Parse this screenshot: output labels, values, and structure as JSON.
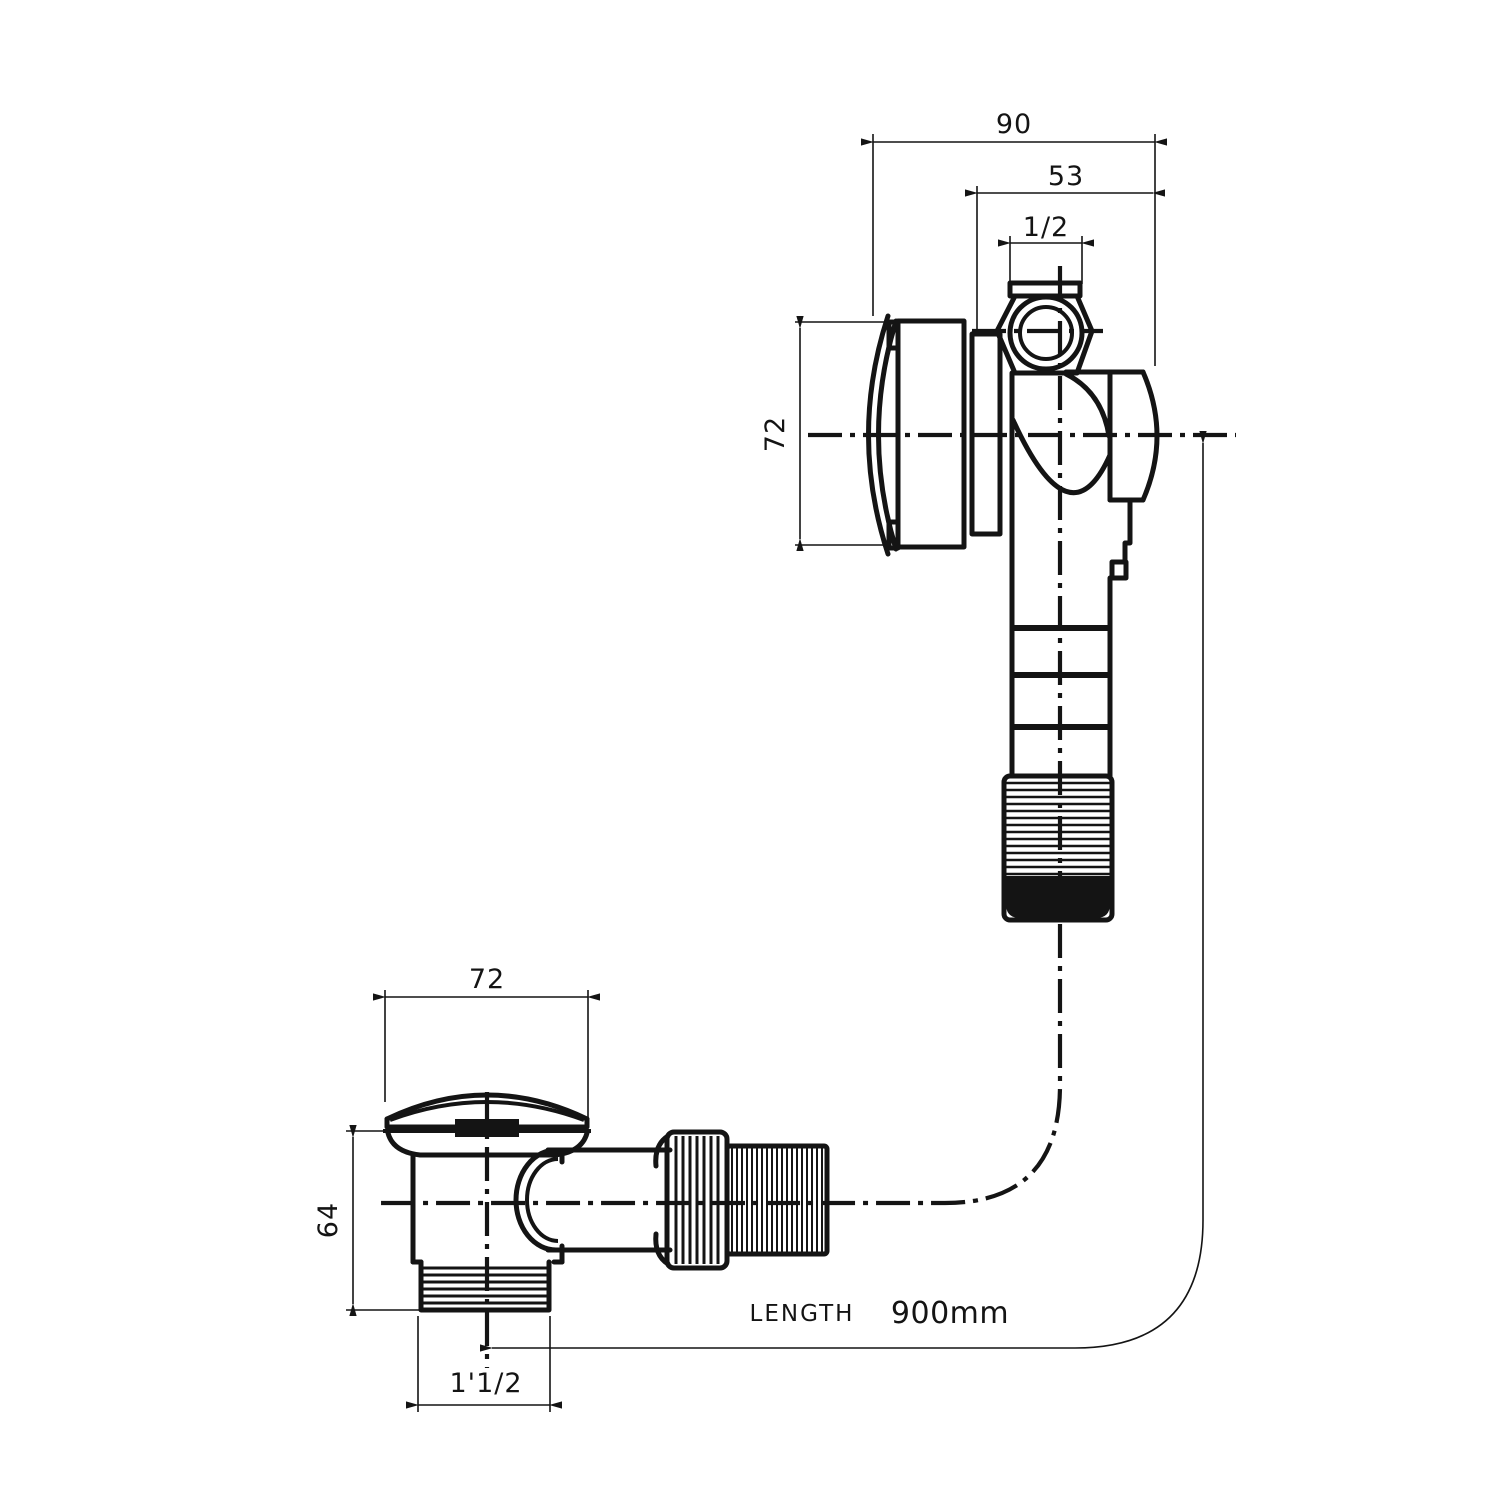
{
  "drawing": {
    "title": "bath-filler-overflow-and-popup-waste-dimension-drawing",
    "colors": {
      "line": "#141414",
      "background": "#ffffff"
    },
    "dimensions": {
      "overflow_width": "90",
      "overflow_offset": "53",
      "inlet_size": "1/2",
      "overflow_face": "72",
      "waste_flange": "72",
      "waste_height": "64",
      "waste_thread": "1'1/2"
    },
    "hose": {
      "label": "LENGTH",
      "value": "900mm"
    }
  }
}
